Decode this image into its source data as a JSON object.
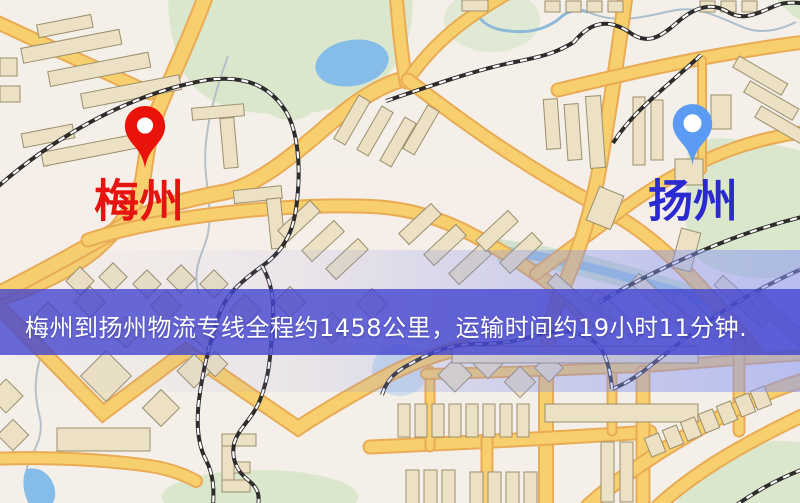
{
  "map": {
    "origin": {
      "label": "梅州"
    },
    "destination": {
      "label": "扬州"
    },
    "banner": {
      "text": "梅州到扬州物流专线全程约1458公里，运输时间约19小时11分钟.",
      "origin": "梅州",
      "destination": "扬州",
      "distance_km": "1458",
      "duration": "19小时11分钟"
    },
    "icons": {
      "origin": "red-map-pin-icon",
      "destination": "blue-map-pin-icon"
    }
  },
  "colors": {
    "pin_red": "#ea1309",
    "pin_blue": "#5b9bf3",
    "label_red": "#e61410",
    "label_blue": "#2a2ad0",
    "banner_bg": "#4345cf",
    "banner_text": "#ffffff",
    "road_fill": "#f8cf6d",
    "road_casing": "#e9ab55",
    "park_green": "#dbe7cd",
    "water_blue": "#85bce8",
    "building_tan": "#ece1c4",
    "map_background": "#f4efe8"
  }
}
